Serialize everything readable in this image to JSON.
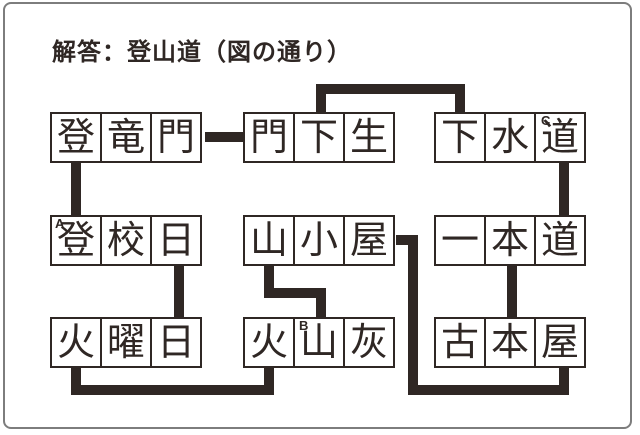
{
  "title": "解答：登山道（図の通り）",
  "answer": "登山道",
  "colors": {
    "ink": "#2f2724",
    "frame": "#7d7d7d",
    "background": "#ffffff"
  },
  "boxes": [
    {
      "word": "登竜門",
      "chars": [
        "登",
        "竜",
        "門"
      ]
    },
    {
      "word": "門下生",
      "chars": [
        "門",
        "下",
        "生"
      ]
    },
    {
      "word": "下水道",
      "chars": [
        "下",
        "水",
        "道"
      ]
    },
    {
      "word": "登校日",
      "chars": [
        "登",
        "校",
        "日"
      ]
    },
    {
      "word": "山小屋",
      "chars": [
        "山",
        "小",
        "屋"
      ]
    },
    {
      "word": "一本道",
      "chars": [
        "一",
        "本",
        "道"
      ]
    },
    {
      "word": "火曜日",
      "chars": [
        "火",
        "曜",
        "日"
      ]
    },
    {
      "word": "火山灰",
      "chars": [
        "火",
        "山",
        "灰"
      ]
    },
    {
      "word": "古本屋",
      "chars": [
        "古",
        "本",
        "屋"
      ]
    }
  ],
  "marks": [
    {
      "letter": "A",
      "cell": "登校日の登"
    },
    {
      "letter": "B",
      "cell": "火山灰の山"
    },
    {
      "letter": "C",
      "cell": "下水道の道"
    }
  ],
  "connections": [
    "登竜門(門)-門下生(門)",
    "門下生(下)-下水道(下)",
    "下水道(道)-一本道(道)",
    "一本道(本)-古本屋(本)",
    "古本屋(屋)-山小屋(屋)",
    "山小屋(山)-火山灰(山)",
    "火山灰(火)-火曜日(火)",
    "火曜日(日)-登校日(日)",
    "登校日(登)-登竜門(登)"
  ]
}
